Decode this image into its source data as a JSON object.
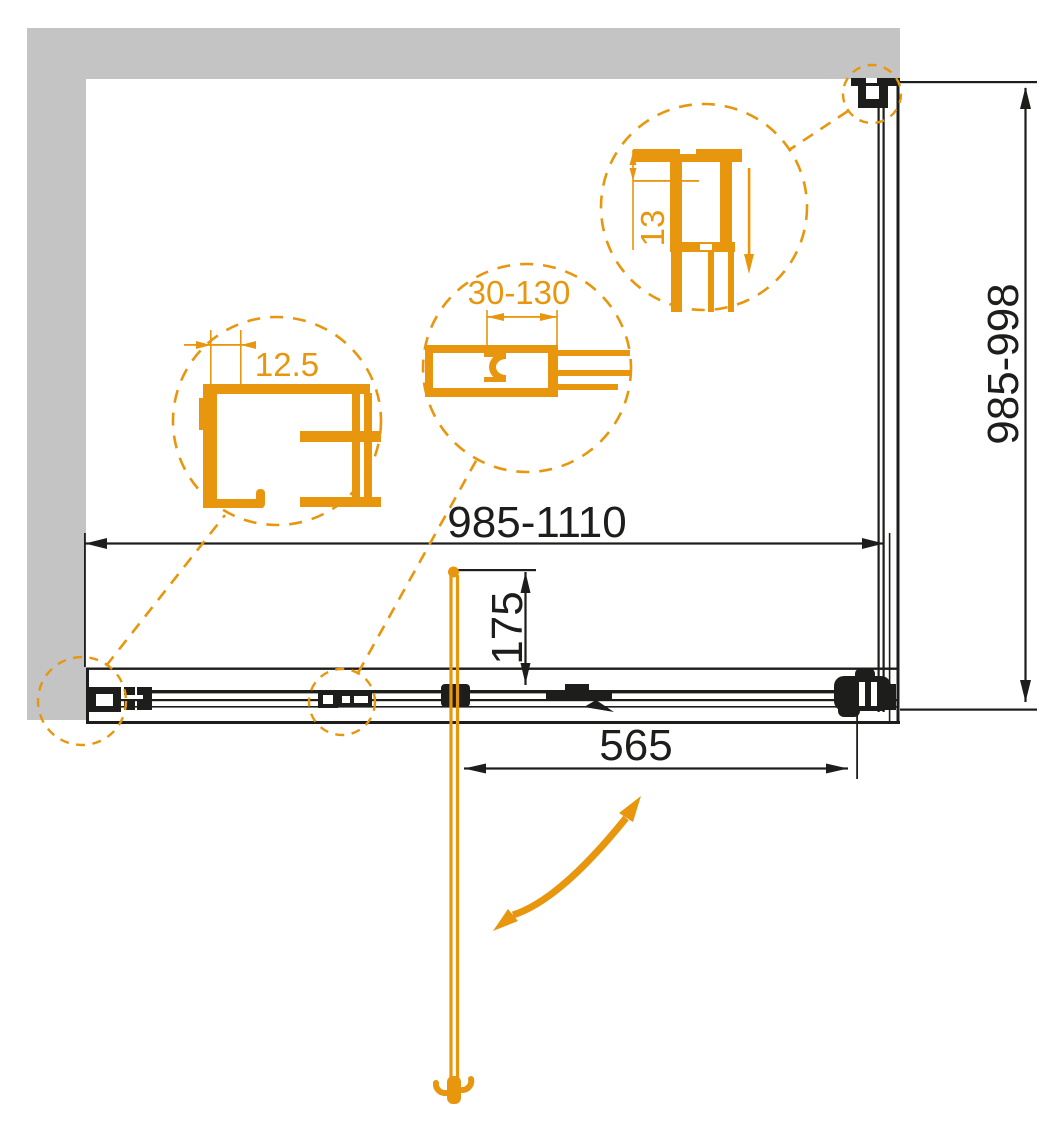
{
  "meta": {
    "drawing_type": "technical installation drawing",
    "subject": "shower enclosure sliding door - plan view"
  },
  "colors": {
    "accent_orange": "#e8960e",
    "wall_gray": "#c4c4c4",
    "ink_black": "#1d1d1b",
    "background": "#ffffff"
  },
  "dimensions": {
    "overall_width_range": "985-1110",
    "side_depth_range": "985-998",
    "door_projection": "175",
    "opening_width": "565"
  },
  "details": {
    "wall_profile_adjustment": "12.5",
    "bracket_adjustment_range": "30-130",
    "top_profile_height": "13"
  }
}
